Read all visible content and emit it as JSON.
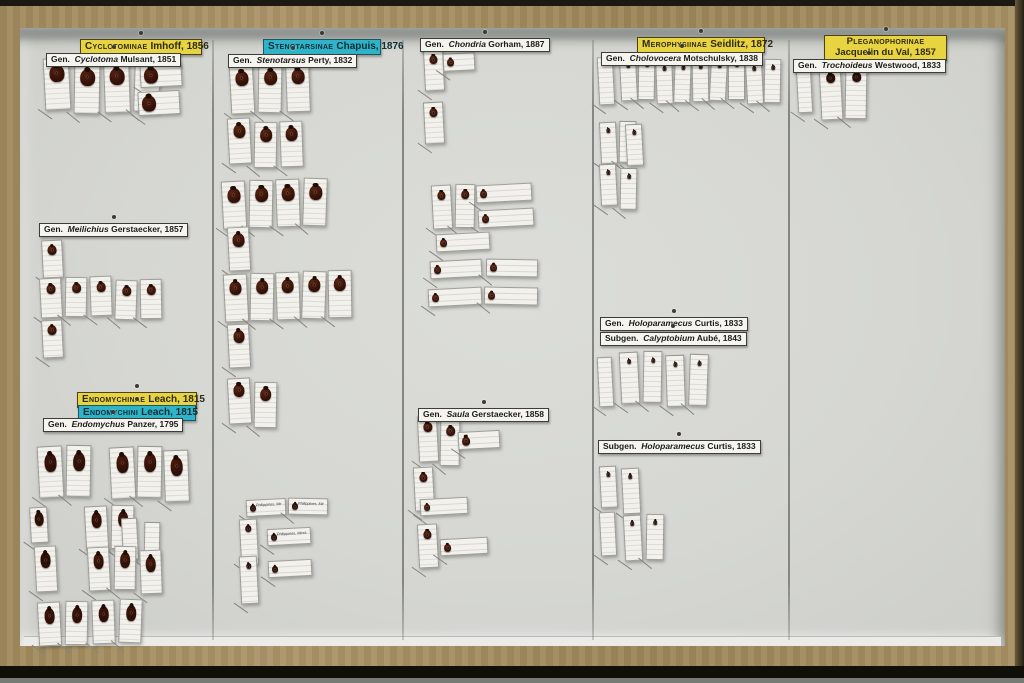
{
  "scene": {
    "description": "Museum entomology drawer (wooden box, glass removed) containing pinned beetle specimens of family Endomychidae arranged in five columns with taxonomic labels",
    "columns": 5
  },
  "colors": {
    "wood": "#a48d61",
    "floor": "#d6d7d3",
    "family_label_bg": "#e8d441",
    "tribe_label_bg": "#2fb3c8",
    "card_bg": "#f2f1eb",
    "beetle_default": "#5e2410"
  },
  "drawer": {
    "separators_x": [
      212,
      402,
      592,
      788
    ],
    "separator_top": 40,
    "separator_bottom": 640
  },
  "labels": [
    {
      "id": "cyclotominae-family",
      "type": "family",
      "name": "Cyclotominae",
      "author": "Imhoff, 1856",
      "x": 80,
      "y": 39,
      "w": 112
    },
    {
      "id": "cyclotoma-genus",
      "type": "genus",
      "prefix": "Gen.",
      "name": "Cyclotoma",
      "author": "Mulsant, 1851",
      "x": 46,
      "y": 53
    },
    {
      "id": "stenotarsinae-family",
      "type": "tribe",
      "name": "Stenotarsinae",
      "author": "Chapuis, 1876",
      "x": 263,
      "y": 39,
      "w": 108
    },
    {
      "id": "stenotarsus-genus",
      "type": "genus",
      "prefix": "Gen.",
      "name": "Stenotarsus",
      "author": "Perty, 1832",
      "x": 228,
      "y": 54
    },
    {
      "id": "chondria-genus",
      "type": "genus",
      "prefix": "Gen.",
      "name": "Chondria",
      "author": "Gorham, 1887",
      "x": 420,
      "y": 38
    },
    {
      "id": "merophysiinae-family",
      "type": "family",
      "name": "Merophysiinae",
      "author": "Seidlitz, 1872",
      "x": 637,
      "y": 37,
      "w": 118
    },
    {
      "id": "cholovocera-genus",
      "type": "genus",
      "prefix": "Gen.",
      "name": "Cholovocera",
      "author": "Motschulsky, 1838",
      "x": 601,
      "y": 52
    },
    {
      "id": "pleganophorinae-family",
      "type": "family",
      "two_line": true,
      "name": "Pleganophorinae",
      "author": "Jacquelin du Val, 1857",
      "x": 824,
      "y": 35,
      "w": 113
    },
    {
      "id": "trochoideus-genus",
      "type": "genus",
      "prefix": "Gen.",
      "name": "Trochoideus",
      "author": "Westwood, 1833",
      "x": 793,
      "y": 59
    },
    {
      "id": "meilichius-genus",
      "type": "genus",
      "prefix": "Gen.",
      "name": "Meilichius",
      "author": "Gerstaecker, 1857",
      "x": 39,
      "y": 223
    },
    {
      "id": "endomychinae-family",
      "type": "family",
      "name": "Endomychinae",
      "author": "Leach, 1815",
      "x": 77,
      "y": 392,
      "w": 110
    },
    {
      "id": "endomychini-tribe",
      "type": "tribe",
      "name": "Endomychini",
      "author": "Leach, 1815",
      "x": 78,
      "y": 405,
      "w": 108
    },
    {
      "id": "endomychus-genus",
      "type": "genus",
      "prefix": "Gen.",
      "name": "Endomychus",
      "author": "Panzer, 1795",
      "x": 43,
      "y": 418
    },
    {
      "id": "saula-genus",
      "type": "genus",
      "prefix": "Gen.",
      "name": "Saula",
      "author": "Gerstaecker, 1858",
      "x": 418,
      "y": 408
    },
    {
      "id": "holoparamecus-genus",
      "type": "genus",
      "prefix": "Gen.",
      "name": "Holoparamecus",
      "author": "Curtis, 1833",
      "x": 600,
      "y": 317
    },
    {
      "id": "calyptobium-subgenus",
      "type": "subgenus",
      "prefix": "Subgen.",
      "name": "Calyptobium",
      "author": "Aubé, 1843",
      "x": 600,
      "y": 332
    },
    {
      "id": "holoparamecus-subgenus",
      "type": "subgenus",
      "prefix": "Subgen.",
      "name": "Holoparamecus",
      "author": "Curtis, 1833",
      "x": 598,
      "y": 440
    }
  ],
  "specimen_groups": [
    {
      "x": 44,
      "y": 60,
      "count": 4,
      "cw": 24,
      "ch": 50,
      "gap": 6,
      "beetle": 15,
      "bcolor": "#55200f"
    },
    {
      "x": 140,
      "y": 62,
      "count": 1,
      "orient": "h",
      "cw": 40,
      "ch": 22,
      "beetle": 14,
      "bcolor": "#55200f"
    },
    {
      "x": 138,
      "y": 92,
      "count": 1,
      "orient": "h",
      "cw": 40,
      "ch": 22,
      "beetle": 14,
      "bcolor": "#55200f"
    },
    {
      "x": 42,
      "y": 238,
      "count": 1,
      "cw": 19,
      "ch": 36,
      "beetle": 9
    },
    {
      "x": 40,
      "y": 278,
      "count": 5,
      "cw": 20,
      "ch": 38,
      "gap": 5,
      "beetle": 9
    },
    {
      "x": 42,
      "y": 322,
      "count": 1,
      "cw": 19,
      "ch": 36,
      "beetle": 9
    },
    {
      "x": 38,
      "y": 445,
      "count": 2,
      "cw": 23,
      "ch": 50,
      "gap": 5,
      "beetle": 12,
      "elong": true,
      "bcolor": "#3c1408"
    },
    {
      "x": 110,
      "y": 448,
      "count": 3,
      "cw": 23,
      "ch": 50,
      "gap": 4,
      "beetle": 12,
      "elong": true,
      "bcolor": "#4a1a0a"
    },
    {
      "x": 30,
      "y": 505,
      "count": 1,
      "cw": 16,
      "ch": 34,
      "beetle": 9,
      "elong": true,
      "bcolor": "#2c0f06"
    },
    {
      "x": 85,
      "y": 506,
      "count": 2,
      "cw": 21,
      "ch": 42,
      "gap": 5,
      "beetle": 10,
      "elong": true,
      "bcolor": "#3c1408"
    },
    {
      "x": 122,
      "y": 520,
      "count": 2,
      "cw": 14,
      "ch": 40,
      "gap": 8
    },
    {
      "x": 35,
      "y": 545,
      "count": 1,
      "cw": 20,
      "ch": 44,
      "beetle": 10,
      "elong": true,
      "bcolor": "#2c0f06"
    },
    {
      "x": 88,
      "y": 548,
      "count": 3,
      "cw": 20,
      "ch": 42,
      "gap": 6,
      "beetle": 10,
      "elong": true,
      "bcolor": "#4a1a0a"
    },
    {
      "x": 38,
      "y": 600,
      "count": 4,
      "cw": 21,
      "ch": 42,
      "gap": 6,
      "beetle": 10,
      "elong": true,
      "bcolor": "#3c1408"
    },
    {
      "x": 230,
      "y": 64,
      "count": 3,
      "cw": 22,
      "ch": 48,
      "gap": 6,
      "beetle": 13,
      "bcolor": "#5c2410"
    },
    {
      "x": 228,
      "y": 120,
      "count": 3,
      "cw": 21,
      "ch": 44,
      "gap": 5,
      "beetle": 12,
      "bcolor": "#5c2410"
    },
    {
      "x": 222,
      "y": 180,
      "count": 4,
      "cw": 22,
      "ch": 46,
      "gap": 5,
      "beetle": 13,
      "bcolor": "#5c2410"
    },
    {
      "x": 228,
      "y": 228,
      "count": 1,
      "cw": 20,
      "ch": 42,
      "beetle": 12,
      "bcolor": "#5c2410"
    },
    {
      "x": 224,
      "y": 272,
      "count": 5,
      "cw": 22,
      "ch": 46,
      "gap": 4,
      "beetle": 12,
      "bcolor": "#5c2410"
    },
    {
      "x": 228,
      "y": 324,
      "count": 1,
      "cw": 20,
      "ch": 42,
      "beetle": 11
    },
    {
      "x": 228,
      "y": 380,
      "count": 2,
      "cw": 21,
      "ch": 44,
      "gap": 5,
      "beetle": 11
    },
    {
      "x": 246,
      "y": 498,
      "count": 2,
      "orient": "h",
      "cw": 38,
      "ch": 15,
      "gap": 4,
      "beetle": 6,
      "bcolor": "#2c0f06",
      "caption": "Philippines, Mindanao"
    },
    {
      "x": 240,
      "y": 520,
      "count": 1,
      "cw": 16,
      "ch": 44,
      "beetle": 6,
      "bcolor": "#2c0f06"
    },
    {
      "x": 267,
      "y": 526,
      "count": 1,
      "orient": "h",
      "cw": 42,
      "ch": 15,
      "beetle": 6,
      "bcolor": "#2c0f06",
      "caption": "Philippines, Mindanao"
    },
    {
      "x": 240,
      "y": 556,
      "count": 1,
      "cw": 16,
      "ch": 46,
      "beetle": 5,
      "bcolor": "#2c0f06"
    },
    {
      "x": 268,
      "y": 562,
      "count": 1,
      "orient": "h",
      "cw": 42,
      "ch": 15,
      "beetle": 6,
      "bcolor": "#2c0f06"
    },
    {
      "x": 424,
      "y": 48,
      "count": 1,
      "cw": 18,
      "ch": 40,
      "beetle": 8
    },
    {
      "x": 443,
      "y": 54,
      "count": 1,
      "orient": "h",
      "cw": 30,
      "ch": 16,
      "beetle": 7
    },
    {
      "x": 424,
      "y": 100,
      "count": 1,
      "cw": 18,
      "ch": 40,
      "beetle": 8
    },
    {
      "x": 432,
      "y": 185,
      "count": 2,
      "cw": 18,
      "ch": 42,
      "gap": 5,
      "beetle": 8
    },
    {
      "x": 476,
      "y": 186,
      "count": 1,
      "orient": "h",
      "cw": 54,
      "ch": 16,
      "beetle": 7
    },
    {
      "x": 478,
      "y": 208,
      "count": 1,
      "orient": "h",
      "cw": 54,
      "ch": 16,
      "beetle": 7
    },
    {
      "x": 436,
      "y": 234,
      "count": 1,
      "orient": "h",
      "cw": 52,
      "ch": 16,
      "beetle": 7
    },
    {
      "x": 430,
      "y": 258,
      "count": 2,
      "orient": "h",
      "cw": 50,
      "ch": 16,
      "gap": 6,
      "beetle": 7
    },
    {
      "x": 428,
      "y": 288,
      "count": 2,
      "orient": "h",
      "cw": 52,
      "ch": 16,
      "gap": 4,
      "beetle": 7
    },
    {
      "x": 418,
      "y": 418,
      "count": 2,
      "cw": 18,
      "ch": 44,
      "gap": 4,
      "beetle": 9
    },
    {
      "x": 458,
      "y": 430,
      "count": 1,
      "orient": "h",
      "cw": 40,
      "ch": 16,
      "beetle": 8
    },
    {
      "x": 414,
      "y": 468,
      "count": 1,
      "cw": 18,
      "ch": 42,
      "beetle": 8
    },
    {
      "x": 420,
      "y": 496,
      "count": 1,
      "orient": "h",
      "cw": 46,
      "ch": 15,
      "beetle": 6
    },
    {
      "x": 418,
      "y": 524,
      "count": 1,
      "cw": 18,
      "ch": 42,
      "beetle": 8
    },
    {
      "x": 440,
      "y": 540,
      "count": 1,
      "orient": "h",
      "cw": 46,
      "ch": 15,
      "beetle": 7
    },
    {
      "x": 598,
      "y": 56,
      "count": 1,
      "cw": 14,
      "ch": 46
    },
    {
      "x": 620,
      "y": 58,
      "count": 9,
      "cw": 15,
      "ch": 42,
      "gap": 3,
      "beetle": 4,
      "bcolor": "#2a1006"
    },
    {
      "x": 600,
      "y": 120,
      "count": 2,
      "cw": 15,
      "ch": 40,
      "gap": 4,
      "beetle": 4,
      "bcolor": "#2a1006"
    },
    {
      "x": 626,
      "y": 124,
      "count": 1,
      "cw": 15,
      "ch": 40,
      "beetle": 4,
      "bcolor": "#2a1006"
    },
    {
      "x": 600,
      "y": 166,
      "count": 2,
      "cw": 15,
      "ch": 40,
      "gap": 5,
      "beetle": 4,
      "bcolor": "#2a1006"
    },
    {
      "x": 598,
      "y": 356,
      "count": 1,
      "cw": 13,
      "ch": 48
    },
    {
      "x": 620,
      "y": 353,
      "count": 4,
      "cw": 17,
      "ch": 50,
      "gap": 6,
      "beetle": 4,
      "bcolor": "#2a1006"
    },
    {
      "x": 600,
      "y": 464,
      "count": 1,
      "cw": 15,
      "ch": 40,
      "beetle": 4,
      "bcolor": "#2a1006"
    },
    {
      "x": 622,
      "y": 468,
      "count": 1,
      "cw": 16,
      "ch": 44,
      "beetle": 4,
      "bcolor": "#2a1006"
    },
    {
      "x": 600,
      "y": 514,
      "count": 1,
      "cw": 14,
      "ch": 42
    },
    {
      "x": 624,
      "y": 514,
      "count": 2,
      "cw": 16,
      "ch": 44,
      "gap": 6,
      "beetle": 4,
      "bcolor": "#2a1006"
    },
    {
      "x": 797,
      "y": 68,
      "count": 1,
      "cw": 13,
      "ch": 44
    },
    {
      "x": 820,
      "y": 64,
      "count": 2,
      "cw": 20,
      "ch": 52,
      "gap": 5,
      "beetle": 9,
      "bcolor": "#241009"
    }
  ]
}
